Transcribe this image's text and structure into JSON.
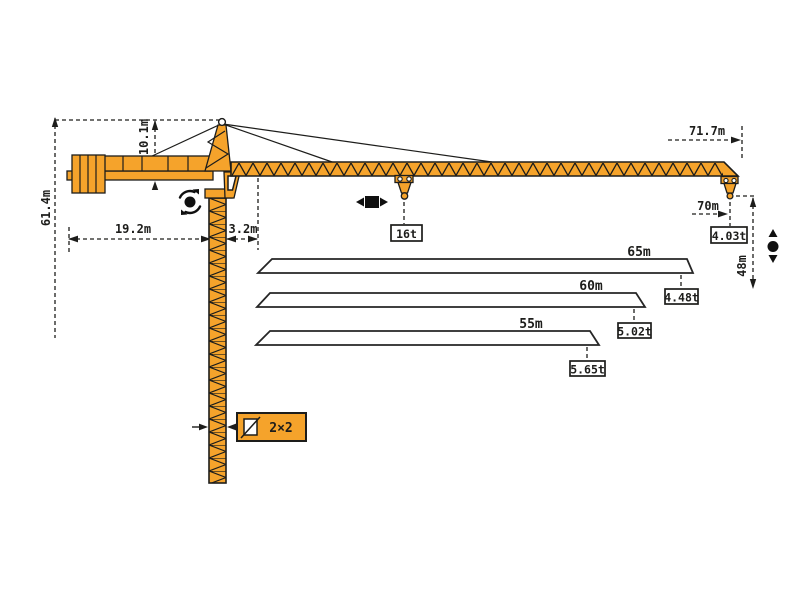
{
  "diagram_title": "tower-crane-working-range-diagram",
  "colors": {
    "crane_yellow": "#F5A32B",
    "outline": "#1D1D1B",
    "background": "#FFFFFF"
  },
  "dims": {
    "total_height": "61.4m",
    "tower_head_height": "10.1m",
    "counter_jib_radius": "19.2m",
    "rear_offset": "3.2m",
    "max_jib_length": "71.7m",
    "max_working_radius": "70m",
    "hook_height": "48m",
    "mast_section": "2×2"
  },
  "loads": {
    "max_load": "16t",
    "tip_load_70m": "4.03t"
  },
  "jib_variants": [
    {
      "length": "65m",
      "tip_load": "4.48t"
    },
    {
      "length": "60m",
      "tip_load": "5.02t"
    },
    {
      "length": "55m",
      "tip_load": "5.65t"
    }
  ],
  "icons": {
    "slewing": "slewing-rotation-icon",
    "trolley": "trolley-travel-icon",
    "hoist": "hoist-up-down-icon",
    "mast_section": "mast-cross-section-icon"
  }
}
